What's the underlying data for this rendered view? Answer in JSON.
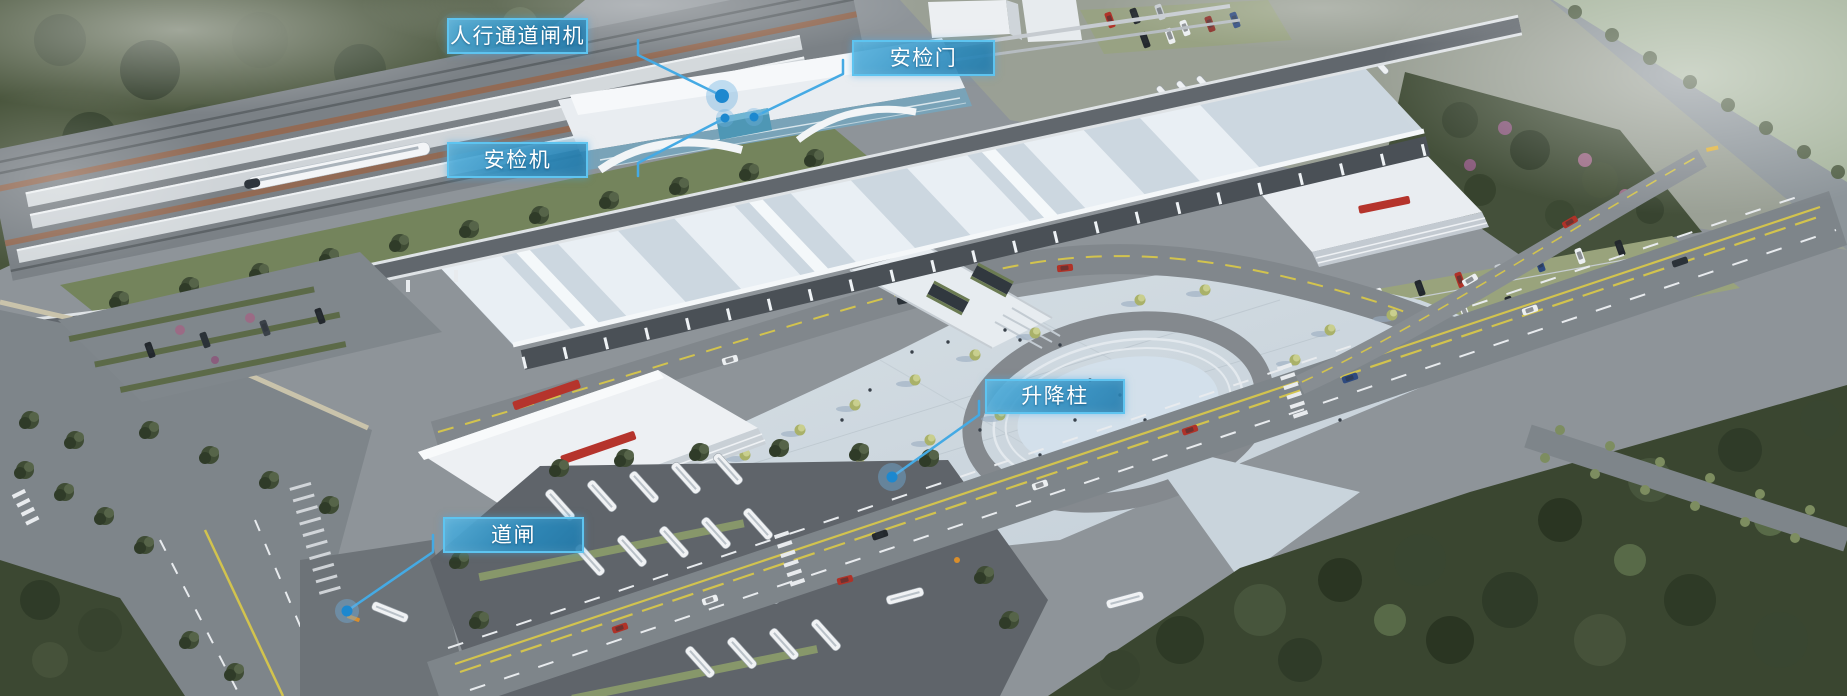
{
  "callouts": {
    "pedestrian_gate": {
      "label": "人行通道闸机"
    },
    "security_door": {
      "label": "安检门"
    },
    "security_machine": {
      "label": "安检机"
    },
    "lifting_bollard": {
      "label": "升降柱"
    },
    "barrier_gate": {
      "label": "道闸"
    }
  },
  "colors": {
    "label_background": "#2e93c4",
    "label_border": "#5ec4f0",
    "label_text": "#ffffff",
    "leader_line": "#45aae4",
    "marker_dot": "#1d88cf"
  }
}
